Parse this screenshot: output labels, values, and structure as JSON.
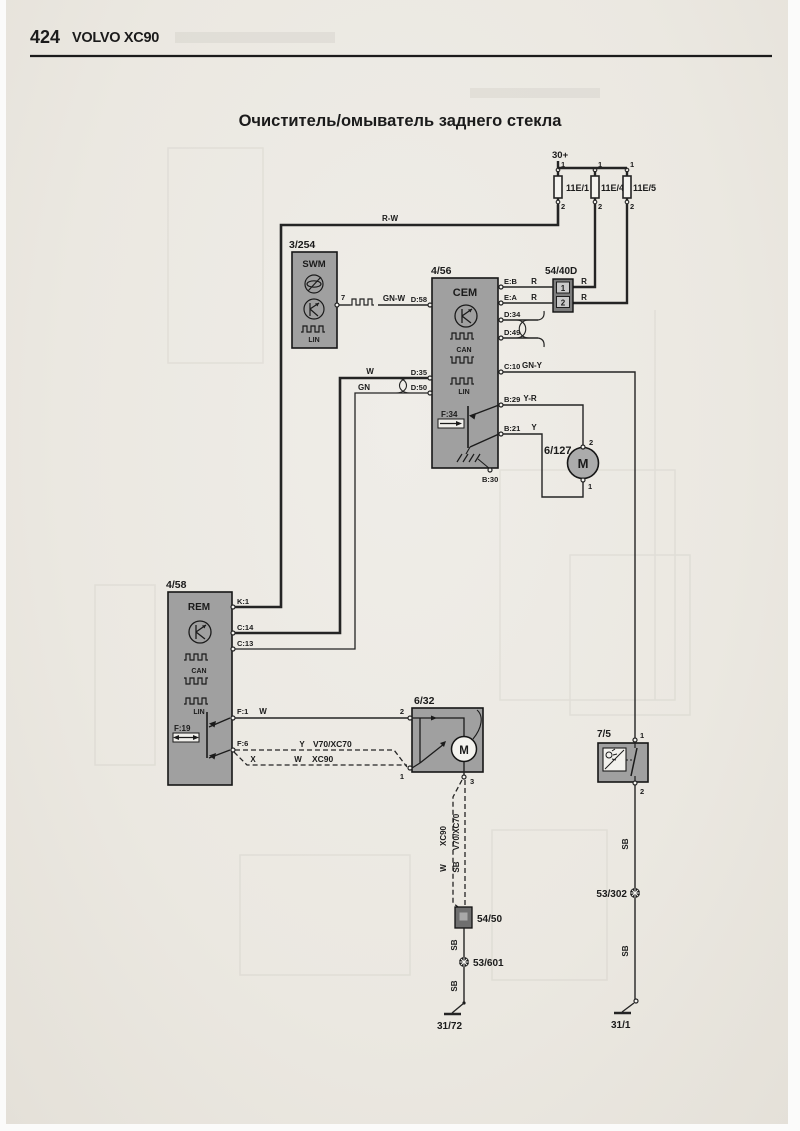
{
  "page": {
    "number": "424",
    "model": "VOLVO XC90",
    "title": "Очиститель/омыватель заднего стекла"
  },
  "power": {
    "rail_label": "30+",
    "pin_top": "1",
    "pin_bottom": "2",
    "fuses": [
      {
        "name": "11E/1"
      },
      {
        "name": "11E/4"
      },
      {
        "name": "11E/5"
      }
    ]
  },
  "wire_labels": {
    "rw": "R-W",
    "r": "R",
    "gnw": "GN-W",
    "w": "W",
    "gn": "GN",
    "gny": "GN-Y",
    "yr": "Y-R",
    "y": "Y",
    "sb": "SB",
    "x": "X"
  },
  "buses": {
    "can": "CAN",
    "lin": "LIN"
  },
  "modules": {
    "swm": {
      "id": "3/254",
      "name": "SWM",
      "pin7": "7"
    },
    "cem": {
      "id": "4/56",
      "name": "CEM",
      "relay": "F:34",
      "pins": {
        "eb": "E:B",
        "ea": "E:A",
        "d34": "D:34",
        "d49": "D:49",
        "c10": "C:10",
        "b29": "B:29",
        "b21": "B:21",
        "b30": "B:30",
        "d58": "D:58",
        "d35": "D:35",
        "d50": "D:50"
      }
    },
    "rem": {
      "id": "4/58",
      "name": "REM",
      "relay": "F:19",
      "pins": {
        "k1": "K:1",
        "c14": "C:14",
        "c13": "C:13",
        "f1": "F:1",
        "f6": "F:6"
      }
    },
    "wiper_motor": {
      "id": "6/32",
      "pin1": "1",
      "pin2": "2",
      "pin3": "3",
      "letter": "M"
    },
    "washer_pump": {
      "id": "6/127",
      "pin1": "1",
      "pin2": "2",
      "letter": "M"
    },
    "level_switch": {
      "id": "7/5",
      "pin1": "1",
      "pin2": "2"
    }
  },
  "connectors": {
    "c5440d": {
      "id": "54/40D",
      "cell1": "1",
      "cell2": "2"
    },
    "c5450": {
      "id": "54/50"
    }
  },
  "splices": {
    "s53601": "53/601",
    "s53302": "53/302"
  },
  "grounds": {
    "g3172": "31/72",
    "g311": "31/1"
  },
  "variants": {
    "v70": "V70/XC70",
    "xc90": "XC90"
  }
}
